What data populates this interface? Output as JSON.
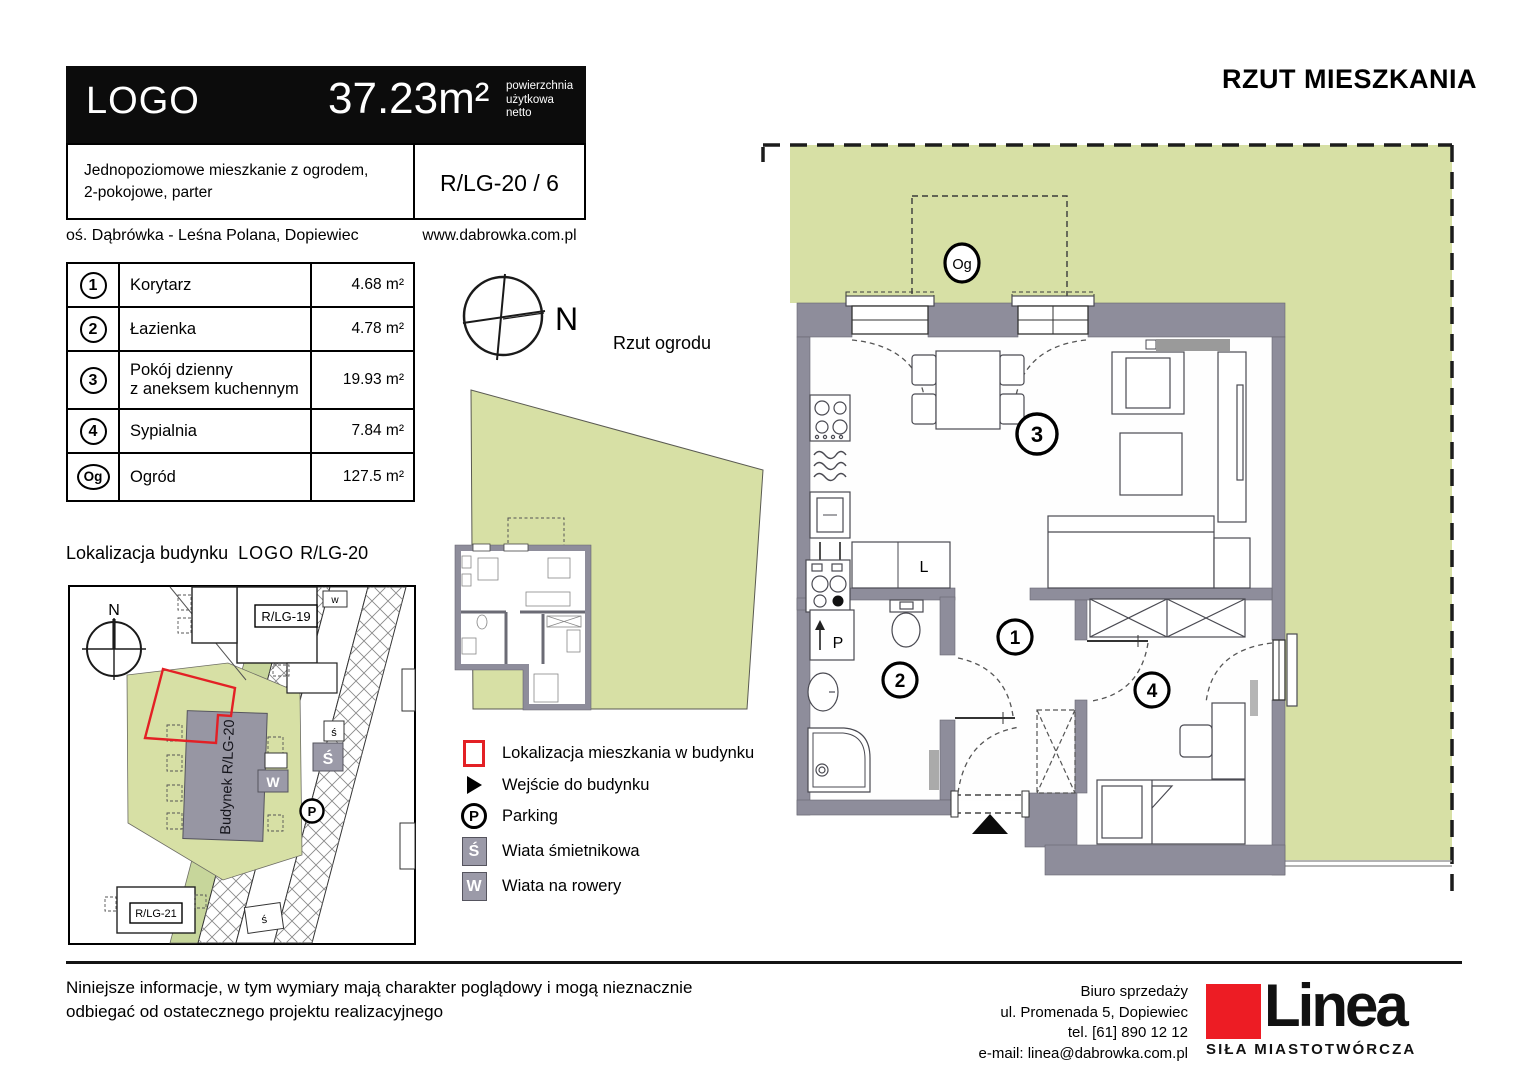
{
  "header": {
    "logo": "LOGO",
    "area": "37.23m²",
    "area_caption": [
      "powierzchnia",
      "użytkowa",
      "netto"
    ],
    "description": [
      "Jednopoziomowe mieszkanie z ogrodem,",
      "2-pokojowe, parter"
    ],
    "unit_code": "R/LG-20 / 6",
    "estate": "oś. Dąbrówka - Leśna Polana, Dopiewiec",
    "website": "www.dabrowka.com.pl"
  },
  "rooms": {
    "rows": [
      {
        "no": "1",
        "name": "Korytarz",
        "name2": "",
        "area": "4.68 m²"
      },
      {
        "no": "2",
        "name": "Łazienka",
        "name2": "",
        "area": "4.78 m²"
      },
      {
        "no": "3",
        "name": "Pokój dzienny",
        "name2": "z aneksem kuchennym",
        "area": "19.93 m²"
      },
      {
        "no": "4",
        "name": "Sypialnia",
        "name2": "",
        "area": "7.84 m²"
      },
      {
        "no": "Og",
        "name": "Ogród",
        "name2": "",
        "area": "127.5 m²"
      }
    ]
  },
  "garden_view": {
    "title": "Rzut ogrodu",
    "compass_label": "N"
  },
  "site_map": {
    "title_prefix": "Lokalizacja budynku",
    "title_logo": "LOGO",
    "title_code": "R/LG-20",
    "compass_label": "N",
    "building_top_label": "R/LG-19",
    "building_bottom_label": "R/LG-21",
    "main_building_label": "Budynek R/LG-20",
    "trash_badge": "Ś",
    "trash_small_top": "ś",
    "trash_small_bottom": "ś",
    "bike_badge": "W",
    "bike_small_top": "w",
    "parking_badge": "P"
  },
  "legend": {
    "items": [
      {
        "label": "Lokalizacja mieszkania w budynku"
      },
      {
        "label": "Wejście do budynku"
      },
      {
        "label": "Parking"
      },
      {
        "label": "Wiata śmietnikowa"
      },
      {
        "label": "Wiata na rowery"
      }
    ],
    "parking_symbol": "P",
    "trash_symbol": "Ś",
    "bike_symbol": "W"
  },
  "plan": {
    "title": "RZUT MIESZKANIA",
    "garden_label": "Og",
    "room_corridor": "1",
    "room_bathroom": "2",
    "room_living": "3",
    "room_bedroom": "4",
    "fridge_label": "L",
    "washer_label": "P"
  },
  "footer": {
    "disclaimer": [
      "Niniejsze informacje, w tym wymiary mają charakter poglądowy i mogą nieznacznie",
      "odbiegać od ostatecznego projektu realizacyjnego"
    ],
    "office": [
      "Biuro sprzedaży",
      "ul. Promenada 5, Dopiewiec",
      "tel. [61] 890 12 12",
      "e-mail: linea@dabrowka.com.pl"
    ],
    "brand": {
      "name": "Linea",
      "tagline": "SIŁA MIASTOTWÓRCZA"
    }
  },
  "colors": {
    "garden_green": "#d7e0a5",
    "wall_gray": "#8e8d9b",
    "accent_red": "#e32025",
    "logo_red": "#ed1c24",
    "badge_gray": "#9b9aa8"
  }
}
